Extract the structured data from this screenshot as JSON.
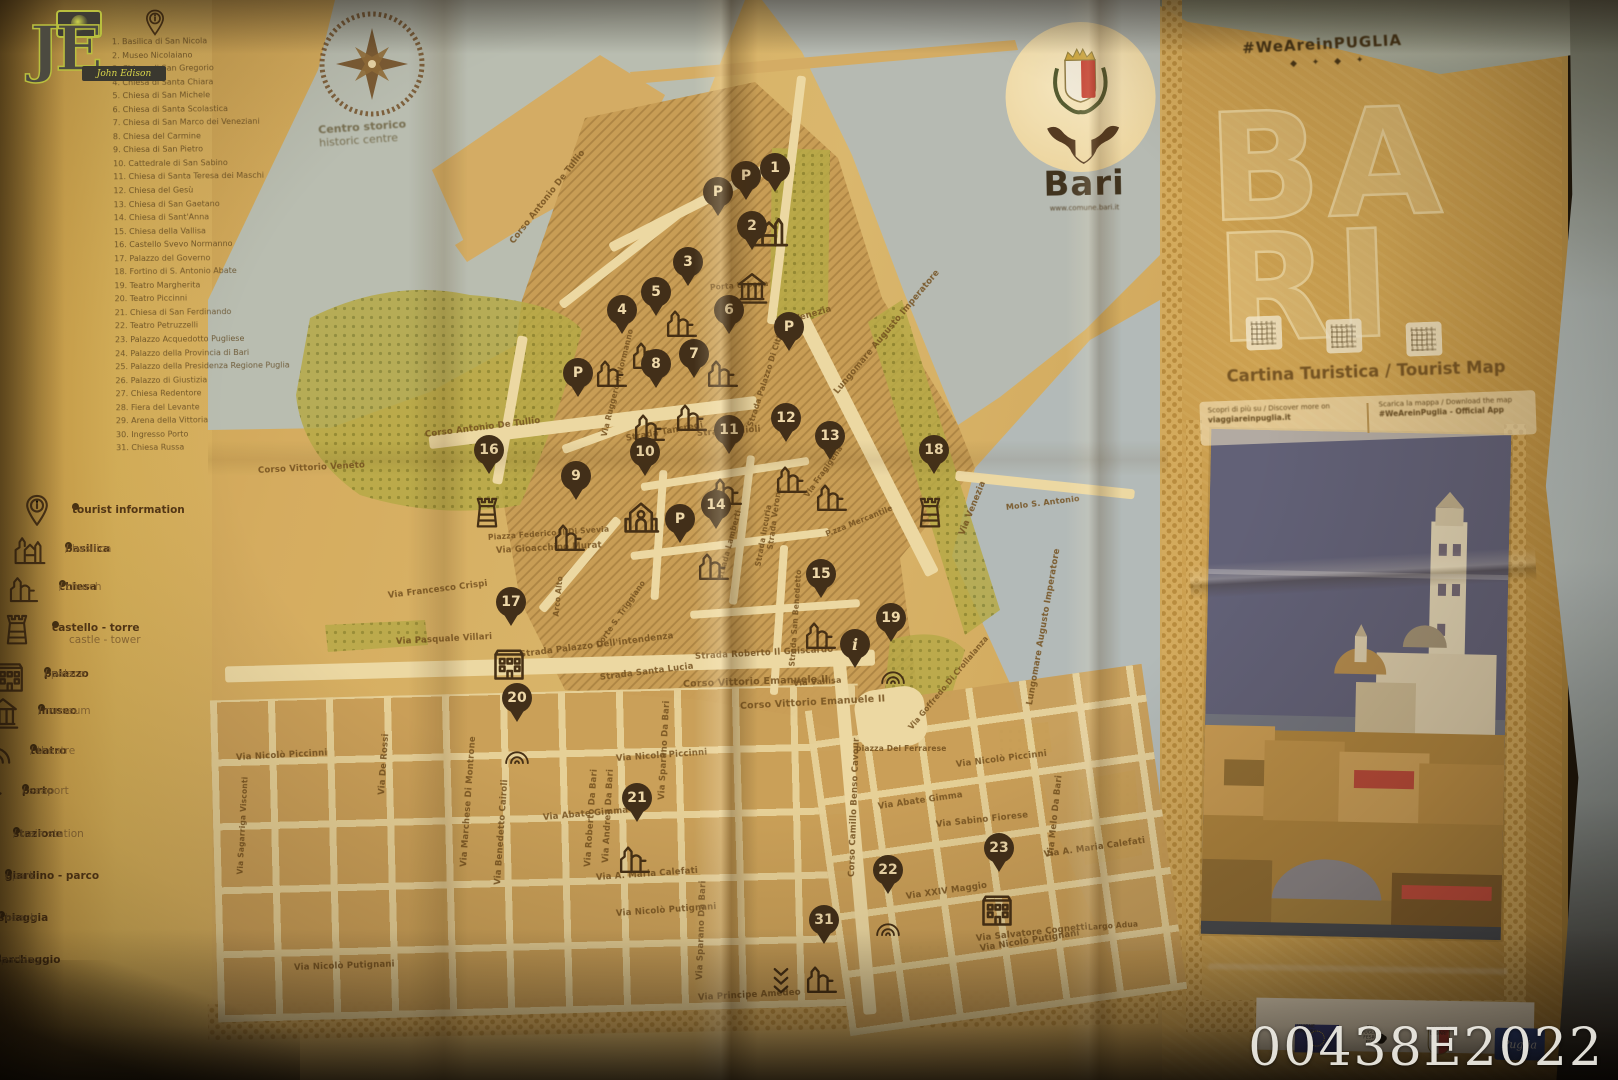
{
  "photo_watermarks": {
    "code": "00438E2022",
    "photographer_initials": "JE",
    "photographer_name": "John Edison"
  },
  "title_panel": {
    "hashtag": "#WeAreinPUGLIA",
    "title_line1": "BA",
    "title_line2": "RI",
    "subtitle": "Cartina Turistica / Tourist Map",
    "info_left_line1": "Scopri di più su / Discover more on",
    "info_left_line2": "viaggiareinpuglia.it",
    "info_right_line1": "Scarica la mappa / Download the map",
    "info_right_line2": "#WeAreinPuglia - Official App"
  },
  "city_logo": {
    "name": "Bari",
    "website": "www.comune.bari.it"
  },
  "compass": {
    "label_it": "Centro storico",
    "label_en": "historic centre"
  },
  "footer_logos": {
    "eu": "UNIONE EUROPEA",
    "po": "PO PUGLIA FESR-FSE",
    "city": "COMUNE DI BARI",
    "promo": "Puglia"
  },
  "colors": {
    "paper": "#d3ad62",
    "sea": "#b5bfba",
    "pin": "#352617",
    "ink": "#4a3318",
    "green": "#b2aa48",
    "street": "#ecdcab"
  },
  "legend_numbered": [
    {
      "n": 1,
      "label": "Basilica di San Nicola"
    },
    {
      "n": 2,
      "label": "Museo Nicolaiano"
    },
    {
      "n": 3,
      "label": "Chiesa di San Gregorio"
    },
    {
      "n": 4,
      "label": "Chiesa di Santa Chiara"
    },
    {
      "n": 5,
      "label": "Chiesa di San Michele"
    },
    {
      "n": 6,
      "label": "Chiesa di Santa Scolastica"
    },
    {
      "n": 7,
      "label": "Chiesa di San Marco dei Veneziani"
    },
    {
      "n": 8,
      "label": "Chiesa del Carmine"
    },
    {
      "n": 9,
      "label": "Chiesa di San Pietro"
    },
    {
      "n": 10,
      "label": "Cattedrale di San Sabino"
    },
    {
      "n": 11,
      "label": "Chiesa di Santa Teresa dei Maschi"
    },
    {
      "n": 12,
      "label": "Chiesa del Gesù"
    },
    {
      "n": 13,
      "label": "Chiesa di San Gaetano"
    },
    {
      "n": 14,
      "label": "Chiesa di Sant'Anna"
    },
    {
      "n": 15,
      "label": "Chiesa della Vallisa"
    },
    {
      "n": 16,
      "label": "Castello Svevo Normanno"
    },
    {
      "n": 17,
      "label": "Palazzo del Governo"
    },
    {
      "n": 18,
      "label": "Fortino di S. Antonio Abate"
    },
    {
      "n": 19,
      "label": "Teatro Margherita"
    },
    {
      "n": 20,
      "label": "Teatro Piccinni"
    },
    {
      "n": 21,
      "label": "Chiesa di San Ferdinando"
    },
    {
      "n": 22,
      "label": "Teatro Petruzzelli"
    },
    {
      "n": 23,
      "label": "Palazzo Acquedotto Pugliese"
    },
    {
      "n": 24,
      "label": "Palazzo della Provincia di Bari"
    },
    {
      "n": 25,
      "label": "Palazzo della Presidenza Regione Puglia"
    },
    {
      "n": 26,
      "label": "Palazzo di Giustizia"
    },
    {
      "n": 27,
      "label": "Chiesa Redentore"
    },
    {
      "n": 28,
      "label": "Fiera del Levante"
    },
    {
      "n": 29,
      "label": "Arena della Vittoria"
    },
    {
      "n": 30,
      "label": "Ingresso Porto"
    },
    {
      "n": 31,
      "label": "Chiesa Russa"
    }
  ],
  "legend_symbols": [
    {
      "icon": "info-pin",
      "it": "tourist information",
      "en": "",
      "x": 72,
      "y": 510
    },
    {
      "icon": "basilica",
      "it": "basilica",
      "en": "basilica",
      "x": 65,
      "y": 549
    },
    {
      "icon": "church",
      "it": "chiesa",
      "en": "church",
      "x": 59,
      "y": 587
    },
    {
      "icon": "tower",
      "it": "castello - torre",
      "en": "castle - tower",
      "x": 52,
      "y": 628
    },
    {
      "icon": "palazzo",
      "it": "palazzo",
      "en": "palace",
      "x": 44,
      "y": 674
    },
    {
      "icon": "museum",
      "it": "museo",
      "en": "museum",
      "x": 38,
      "y": 711
    },
    {
      "icon": "theatre",
      "it": "teatro",
      "en": "theatre",
      "x": 30,
      "y": 751
    },
    {
      "icon": "anchor",
      "it": "porto",
      "en": "seaport",
      "x": 22,
      "y": 791
    },
    {
      "icon": "",
      "it": "stazione",
      "en": "train station",
      "x": 13,
      "y": 834
    },
    {
      "icon": "",
      "it": "giardino - parco",
      "en": "park",
      "x": 5,
      "y": 876
    },
    {
      "icon": "",
      "it": "spiaggia",
      "en": "beach",
      "x": -2,
      "y": 918
    },
    {
      "icon": "",
      "it": "parcheggio",
      "en": "parking",
      "x": -6,
      "y": 960
    }
  ],
  "map_markers": [
    {
      "n": "1",
      "x": 775,
      "y": 168,
      "icon": "basilica",
      "ix": -6,
      "iy": 40
    },
    {
      "n": "2",
      "x": 752,
      "y": 226,
      "icon": "museum",
      "ix": 0,
      "iy": 44
    },
    {
      "n": "3",
      "x": 688,
      "y": 262,
      "icon": "church",
      "ix": -6,
      "iy": 42
    },
    {
      "n": "5",
      "x": 656,
      "y": 292,
      "icon": "church",
      "ix": -8,
      "iy": 44
    },
    {
      "n": "4",
      "x": 622,
      "y": 310,
      "icon": "church",
      "ix": -10,
      "iy": 44
    },
    {
      "n": "6",
      "x": 729,
      "y": 310,
      "icon": "church",
      "ix": -6,
      "iy": 44
    },
    {
      "n": "8",
      "x": 656,
      "y": 364,
      "icon": "church",
      "ix": -6,
      "iy": 44
    },
    {
      "n": "7",
      "x": 694,
      "y": 354,
      "icon": "church",
      "ix": -2,
      "iy": 44
    },
    {
      "n": "9",
      "x": 576,
      "y": 476,
      "icon": "church",
      "ix": -6,
      "iy": 42
    },
    {
      "n": "10",
      "x": 645,
      "y": 452,
      "icon": "cathedral",
      "ix": -4,
      "iy": 44
    },
    {
      "n": "11",
      "x": 729,
      "y": 430,
      "icon": "church",
      "ix": -2,
      "iy": 42
    },
    {
      "n": "12",
      "x": 786,
      "y": 418,
      "icon": "church",
      "ix": 6,
      "iy": 42
    },
    {
      "n": "13",
      "x": 830,
      "y": 436,
      "icon": "church",
      "ix": 2,
      "iy": 42
    },
    {
      "n": "14",
      "x": 716,
      "y": 505,
      "icon": "church",
      "ix": -2,
      "iy": 42
    },
    {
      "n": "15",
      "x": 821,
      "y": 574,
      "icon": "church",
      "ix": 0,
      "iy": 42
    },
    {
      "n": "16",
      "x": 489,
      "y": 450,
      "icon": "tower",
      "ix": -2,
      "iy": 42
    },
    {
      "n": "17",
      "x": 511,
      "y": 602,
      "icon": "palazzo",
      "ix": -2,
      "iy": 42
    },
    {
      "n": "18",
      "x": 934,
      "y": 450,
      "icon": "tower",
      "ix": -4,
      "iy": 42
    },
    {
      "n": "19",
      "x": 891,
      "y": 618,
      "icon": "theatre",
      "ix": 2,
      "iy": 44
    },
    {
      "n": "20",
      "x": 517,
      "y": 698,
      "icon": "theatre",
      "ix": 0,
      "iy": 44
    },
    {
      "n": "21",
      "x": 637,
      "y": 798,
      "icon": "church",
      "ix": -2,
      "iy": 42
    },
    {
      "n": "22",
      "x": 888,
      "y": 870,
      "icon": "theatre",
      "ix": 0,
      "iy": 44
    },
    {
      "n": "23",
      "x": 999,
      "y": 848,
      "icon": "palazzo",
      "ix": -2,
      "iy": 42
    },
    {
      "n": "31",
      "x": 824,
      "y": 920,
      "icon": "russian",
      "ix": -2,
      "iy": 40
    },
    {
      "n": "P",
      "x": 718,
      "y": 192
    },
    {
      "n": "P",
      "x": 746,
      "y": 176
    },
    {
      "n": "P",
      "x": 578,
      "y": 373
    },
    {
      "n": "P",
      "x": 789,
      "y": 327
    },
    {
      "n": "P",
      "x": 680,
      "y": 519
    },
    {
      "n": "i",
      "x": 855,
      "y": 644
    }
  ],
  "streets": [
    {
      "t": "Corso Antonio De Tullio",
      "x": 512,
      "y": 238,
      "r": -52
    },
    {
      "t": "Corso Antonio De Tullio",
      "x": 425,
      "y": 430,
      "r": -7
    },
    {
      "t": "Corso Vittorio Veneto",
      "x": 258,
      "y": 466,
      "r": -3
    },
    {
      "t": "Via Venezia",
      "x": 776,
      "y": 320,
      "r": -16
    },
    {
      "t": "Via Venezia",
      "x": 962,
      "y": 530,
      "r": -68
    },
    {
      "t": "Lungomare Augusto Imperatore",
      "x": 836,
      "y": 388,
      "r": -50
    },
    {
      "t": "Lungomare Augusto Imperatore",
      "x": 1030,
      "y": 700,
      "r": -80
    },
    {
      "t": "Strada Palazzo Di Città",
      "x": 750,
      "y": 422,
      "r": -72,
      "s": 7.5
    },
    {
      "t": "Porta Urbana",
      "x": 710,
      "y": 283,
      "r": -4,
      "s": 7.5
    },
    {
      "t": "Strada Tancredi",
      "x": 626,
      "y": 434,
      "r": -10
    },
    {
      "t": "Strada  Filioli",
      "x": 697,
      "y": 429,
      "r": -4
    },
    {
      "t": "Piazza Federico II Di Svevia",
      "x": 488,
      "y": 533,
      "r": -4,
      "s": 7.5
    },
    {
      "t": "Arco Alto",
      "x": 556,
      "y": 612,
      "r": -84,
      "s": 7.5
    },
    {
      "t": "Corte S. Triggiano",
      "x": 598,
      "y": 642,
      "r": -55,
      "s": 7.5
    },
    {
      "t": "Strada  Lamberti",
      "x": 720,
      "y": 575,
      "r": -75,
      "s": 7.5
    },
    {
      "t": "Strada Verone",
      "x": 770,
      "y": 545,
      "r": -82,
      "s": 7.5
    },
    {
      "t": "Strada San Benedetto",
      "x": 792,
      "y": 662,
      "r": -86,
      "s": 7.5
    },
    {
      "t": "P.zza Mercantile",
      "x": 826,
      "y": 530,
      "r": -22,
      "s": 7.5
    },
    {
      "t": "Via Vallisa",
      "x": 793,
      "y": 679,
      "r": -4,
      "s": 8
    },
    {
      "t": "piazza Del Ferrarese",
      "x": 856,
      "y": 744,
      "r": 0,
      "s": 7.5
    },
    {
      "t": "Strada  Santa Lucia",
      "x": 600,
      "y": 673,
      "r": -7
    },
    {
      "t": "Strada Palazzo Dell'intendenza",
      "x": 520,
      "y": 650,
      "r": -7
    },
    {
      "t": "Strada Roberto Il Guiscardo",
      "x": 695,
      "y": 652,
      "r": -3
    },
    {
      "t": "Corso Vittorio Emanuele II",
      "x": 683,
      "y": 679,
      "r": -2,
      "s": 9.5
    },
    {
      "t": "Corso Vittorio Emanuele II",
      "x": 740,
      "y": 701,
      "r": -3,
      "s": 9.5
    },
    {
      "t": "Via Nicolò Piccinni",
      "x": 616,
      "y": 754,
      "r": -4
    },
    {
      "t": "Via Nicolò Piccinni",
      "x": 956,
      "y": 760,
      "r": -7
    },
    {
      "t": "Via Nicolò Piccinni",
      "x": 236,
      "y": 753,
      "r": -3
    },
    {
      "t": "Via Abate Gimma",
      "x": 543,
      "y": 813,
      "r": -5
    },
    {
      "t": "Via Abate Gimma",
      "x": 878,
      "y": 802,
      "r": -8
    },
    {
      "t": "Via A. Maria Calefati",
      "x": 596,
      "y": 873,
      "r": -4
    },
    {
      "t": "Via A. Maria Calefati",
      "x": 1044,
      "y": 850,
      "r": -8
    },
    {
      "t": "Via Nicolò Putignani",
      "x": 616,
      "y": 909,
      "r": -4
    },
    {
      "t": "Via Nicolò Putignani",
      "x": 294,
      "y": 963,
      "r": -2
    },
    {
      "t": "Via Nicolò Putignani",
      "x": 980,
      "y": 944,
      "r": -9
    },
    {
      "t": "Via Principe Amedeo",
      "x": 698,
      "y": 993,
      "r": -3
    },
    {
      "t": "Via Benedetto Cairoli",
      "x": 498,
      "y": 880,
      "r": -86
    },
    {
      "t": "Via Marchese Di Montrone",
      "x": 464,
      "y": 862,
      "r": -86
    },
    {
      "t": "Via Roberto Da Bari",
      "x": 588,
      "y": 862,
      "r": -86
    },
    {
      "t": "Via Andrea Da Bari",
      "x": 606,
      "y": 858,
      "r": -87
    },
    {
      "t": "Via Sparano Da Bari",
      "x": 662,
      "y": 795,
      "r": -87
    },
    {
      "t": "Via Sparano Da Bari",
      "x": 700,
      "y": 975,
      "r": -88
    },
    {
      "t": "Via Melo Da Bari",
      "x": 1051,
      "y": 852,
      "r": -84
    },
    {
      "t": "Corso Camillo Benso Cavour",
      "x": 852,
      "y": 872,
      "r": -88
    },
    {
      "t": "Via Sabino Fiorese",
      "x": 936,
      "y": 820,
      "r": -6
    },
    {
      "t": "Via XXIV Maggio",
      "x": 906,
      "y": 892,
      "r": -8
    },
    {
      "t": "Via Salvatore Cognetti",
      "x": 976,
      "y": 934,
      "r": -6
    },
    {
      "t": "Via De Rossi",
      "x": 382,
      "y": 790,
      "r": -86
    },
    {
      "t": "Via Gioacchino Murat",
      "x": 496,
      "y": 546,
      "r": -3
    },
    {
      "t": "Via Francesco Crispi",
      "x": 388,
      "y": 591,
      "r": -7
    },
    {
      "t": "Via Pasquale Villari",
      "x": 396,
      "y": 637,
      "r": -3
    },
    {
      "t": "Molo S. Antonio",
      "x": 1006,
      "y": 503,
      "r": -7,
      "s": 8
    },
    {
      "t": "Via Goffredo Di Crollalanza",
      "x": 910,
      "y": 724,
      "r": -50,
      "s": 7.5
    },
    {
      "t": "Largo Adua",
      "x": 1088,
      "y": 923,
      "r": -4,
      "s": 7.5
    },
    {
      "t": "Via Ruggero Il Normanno",
      "x": 604,
      "y": 432,
      "r": -76,
      "s": 7.5
    },
    {
      "t": "Via Fragigena",
      "x": 806,
      "y": 492,
      "r": -55,
      "s": 7.5
    },
    {
      "t": "Via Sagarriga Visconti",
      "x": 240,
      "y": 870,
      "r": -87,
      "s": 7.5
    },
    {
      "t": "Strada Incuria",
      "x": 758,
      "y": 562,
      "r": -80,
      "s": 7.5
    }
  ]
}
